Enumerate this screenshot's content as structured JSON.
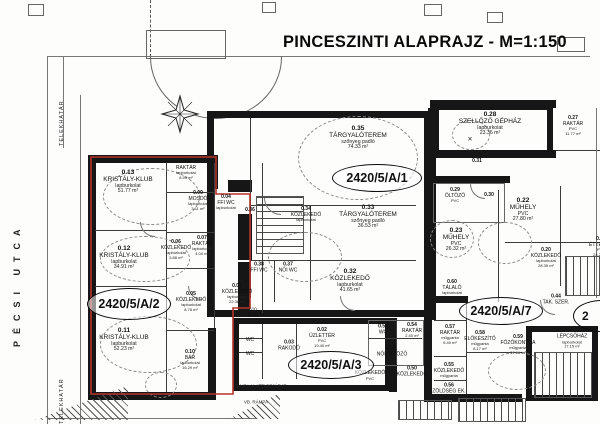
{
  "title": "PINCESZINTI ALAPRAJZ - M=1:150",
  "street": "PÉCSI UTCA",
  "boundary": {
    "top": "TELEKHATÁR",
    "bottom": "TELEKHATÁR"
  },
  "units": {
    "a1": "2420/5/A/1",
    "a2": "2420/5/A/2",
    "a3": "2420/5/A/3",
    "a7": "2420/5/A/7",
    "partial": "2"
  },
  "annotations": {
    "ramp": "VB. RÁMPA",
    "entry": "RÁMPA ALATTI BEJÁRAT",
    "dim": "610",
    "cross": "×"
  },
  "colors": {
    "wall": "#161616",
    "thin_line": "#555555",
    "unit_outline_red": "#b5342c",
    "paper": "#fdfdfc"
  },
  "rooms": {
    "r13": {
      "num": "0.13",
      "name": "KRISTÁLY-KLUB",
      "sub": "lapburkolat",
      "area": "51.77 m²"
    },
    "r12": {
      "num": "0.12",
      "name": "KRISTÁLY-KLUB",
      "sub": "lapburkolat",
      "area": "34.91 m²"
    },
    "r11": {
      "num": "0.11",
      "name": "KRISTÁLY-KLUB",
      "sub": "lapburkolat",
      "area": "52.23 m²"
    },
    "r10": {
      "num": "0.10",
      "name": "BÁR",
      "sub": "lapburkolat",
      "area": "16.29 m²"
    },
    "r08": {
      "num": "0.08",
      "name": "RAKTÁR",
      "sub": "lapburkolat",
      "area": "8.99 m²"
    },
    "r09": {
      "num": "0.09",
      "name": "MOSDÓ",
      "sub": "lapburkolat",
      "area": "3.11 m²"
    },
    "r07": {
      "num": "0.07",
      "name": "RAKTÁR",
      "sub": "lapburkolat",
      "area": "4.04 m²"
    },
    "r06": {
      "num": "0.06",
      "name": "KÖZLEKEDŐ",
      "sub": "lapburkolat",
      "area": "3.88 m²"
    },
    "r06b": {
      "num": "0.06",
      "name": "",
      "sub": "",
      "area": ""
    },
    "r05": {
      "num": "0.05",
      "name": "KÖZLEKEDŐ",
      "sub": "lapburkolat",
      "area": "8.78 m²"
    },
    "r04": {
      "num": "0.04",
      "name": "FFI WC",
      "sub": "lapburkolat",
      "area": ""
    },
    "r01": {
      "num": "0.01",
      "name": "KÖZLEKEDŐ",
      "sub": "lapburkolat",
      "area": "22.36 m²"
    },
    "r02": {
      "num": "0.02",
      "name": "ÜZLETTÉR",
      "sub": "PVC",
      "area": "19.40 m²"
    },
    "r03": {
      "num": "0.03",
      "name": "RAKODÓ",
      "sub": "",
      "area": ""
    },
    "wc1": {
      "num": "",
      "name": "WC",
      "sub": "",
      "area": ""
    },
    "wc2": {
      "num": "",
      "name": "WC",
      "sub": "",
      "area": ""
    },
    "r36": {
      "num": "0.36",
      "name": "",
      "sub": "",
      "area": ""
    },
    "r34": {
      "num": "0.34",
      "name": "KÖZLEKEDŐ",
      "sub": "lapburkolat",
      "area": ""
    },
    "r35": {
      "num": "0.35",
      "name": "TÁRGYALÓTEREM",
      "sub": "szőnyeg padló",
      "area": "74.33 m²"
    },
    "r33": {
      "num": "0.33",
      "name": "TÁRGYALÓTEREM",
      "sub": "szőnyeg padló",
      "area": "36.53 m²"
    },
    "r32": {
      "num": "0.32",
      "name": "KÖZLEKEDŐ",
      "sub": "lapburkolat",
      "area": "41.65 m²"
    },
    "r38": {
      "num": "0.38",
      "name": "FFI WC",
      "sub": "",
      "area": ""
    },
    "r37": {
      "num": "0.37",
      "name": "NŐI WC",
      "sub": "",
      "area": ""
    },
    "r28": {
      "num": "0.28",
      "name": "SZELLŐZŐ GÉPHÁZ",
      "sub": "lapburkolat",
      "area": "23.36 m²"
    },
    "r27": {
      "num": "0.27",
      "name": "RAKTÁR",
      "sub": "PVC",
      "area": "11.77 m²"
    },
    "r31": {
      "num": "0.31",
      "name": "",
      "sub": "",
      "area": ""
    },
    "r29": {
      "num": "0.29",
      "name": "ÖLTÖZŐ",
      "sub": "PVC",
      "area": ""
    },
    "r30": {
      "num": "0.30",
      "name": "",
      "sub": "",
      "area": ""
    },
    "r23": {
      "num": "0.23",
      "name": "MŰHELY",
      "sub": "PVC",
      "area": "26.32 m²"
    },
    "r22": {
      "num": "0.22",
      "name": "MŰHELY",
      "sub": "PVC",
      "area": "27.80 m²"
    },
    "r21": {
      "num": "0.21",
      "name": "ÉTTEREM",
      "sub": "PVC",
      "area": "24.20 m²"
    },
    "r20": {
      "num": "0.20",
      "name": "KÖZLEKEDŐ",
      "sub": "lapburkolat",
      "area": "28.35 m²"
    },
    "r44": {
      "num": "0.44",
      "name": "TAK. SZER.",
      "sub": "",
      "area": ""
    },
    "r60": {
      "num": "0.60",
      "name": "TÁLALÓ",
      "sub": "lapburkolat",
      "area": ""
    },
    "r57": {
      "num": "0.57",
      "name": "RAKTÁR",
      "sub": "műgyanta",
      "area": "6.40 m²"
    },
    "r58": {
      "num": "0.58",
      "name": "ELŐKÉSZÍTŐ",
      "sub": "műgyanta",
      "area": "8.17 m²"
    },
    "r59": {
      "num": "0.59",
      "name": "FŐZŐKONYHA",
      "sub": "műgyanta",
      "area": "37.66 m²"
    },
    "r55": {
      "num": "0.55",
      "name": "KÖZLEKEDŐ",
      "sub": "műgyanta",
      "area": ""
    },
    "r56": {
      "num": "0.56",
      "name": "ZÖLDSÉG EK.",
      "sub": "műgyanta",
      "area": ""
    },
    "r53": {
      "num": "0.53",
      "name": "WC",
      "sub": "",
      "area": ""
    },
    "r54": {
      "num": "0.54",
      "name": "RAKTÁR",
      "sub": "",
      "area": "2.40 m²"
    },
    "r51": {
      "num": "0.51",
      "name": "NŐI ÖLTÖZŐ",
      "sub": "",
      "area": ""
    },
    "r50": {
      "num": "0.50",
      "name": "KÖZLEKEDŐ",
      "sub": "",
      "area": ""
    },
    "kpvc": {
      "num": "",
      "name": "KÖZLEKEDŐ",
      "sub": "PVC",
      "area": ""
    },
    "lepcso": {
      "num": "",
      "name": "LÉPCSŐHÁZ",
      "sub": "lapburkolat",
      "area": "17.15 m²"
    }
  }
}
